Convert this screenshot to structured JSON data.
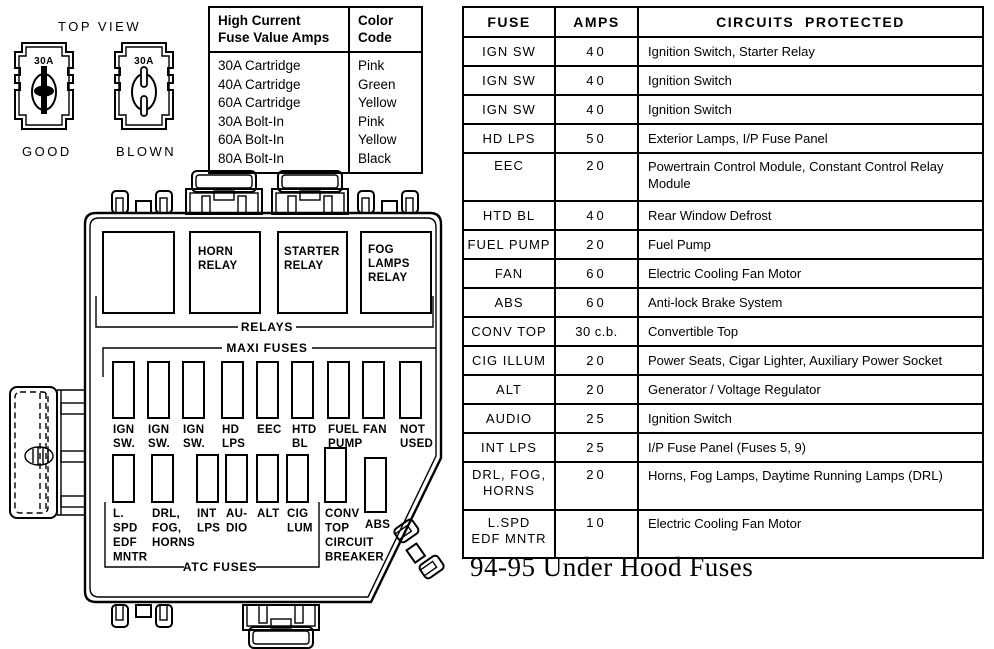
{
  "top_view": {
    "label": "TOP VIEW",
    "good": {
      "amps": "30A",
      "label": "GOOD"
    },
    "blown": {
      "amps": "30A",
      "label": "BLOWN"
    }
  },
  "legend": {
    "header_fuse": "High Current\nFuse Value Amps",
    "header_color": "Color\nCode",
    "rows": [
      {
        "value": "30A Cartridge",
        "color": "Pink"
      },
      {
        "value": "40A Cartridge",
        "color": "Green"
      },
      {
        "value": "60A Cartridge",
        "color": "Yellow"
      },
      {
        "value": "30A Bolt-In",
        "color": "Pink"
      },
      {
        "value": "60A Bolt-In",
        "color": "Yellow"
      },
      {
        "value": "80A Bolt-In",
        "color": "Black"
      }
    ]
  },
  "fuse_table": {
    "headers": {
      "fuse": "FUSE",
      "amps": "AMPS",
      "circuits": "CIRCUITS  PROTECTED"
    },
    "rows": [
      {
        "fuse": "IGN SW",
        "amps": "40",
        "circuits": "Ignition Switch, Starter Relay"
      },
      {
        "fuse": "IGN SW",
        "amps": "40",
        "circuits": "Ignition Switch"
      },
      {
        "fuse": "IGN SW",
        "amps": "40",
        "circuits": "Ignition Switch"
      },
      {
        "fuse": "HD LPS",
        "amps": "50",
        "circuits": "Exterior Lamps, I/P Fuse Panel"
      },
      {
        "fuse": "EEC",
        "amps": "20",
        "circuits": "Powertrain Control Module, Constant Control Relay\nModule"
      },
      {
        "fuse": "HTD BL",
        "amps": "40",
        "circuits": "Rear Window Defrost"
      },
      {
        "fuse": "FUEL PUMP",
        "amps": "20",
        "circuits": "Fuel Pump"
      },
      {
        "fuse": "FAN",
        "amps": "60",
        "circuits": "Electric Cooling Fan Motor"
      },
      {
        "fuse": "ABS",
        "amps": "60",
        "circuits": "Anti-lock Brake System"
      },
      {
        "fuse": "CONV TOP",
        "amps": "30 c.b.",
        "circuits": "Convertible Top"
      },
      {
        "fuse": "CIG ILLUM",
        "amps": "20",
        "circuits": "Power Seats, Cigar Lighter, Auxiliary Power Socket"
      },
      {
        "fuse": "ALT",
        "amps": "20",
        "circuits": "Generator / Voltage Regulator"
      },
      {
        "fuse": "AUDIO",
        "amps": "25",
        "circuits": "Ignition Switch"
      },
      {
        "fuse": "INT LPS",
        "amps": "25",
        "circuits": "I/P Fuse Panel (Fuses 5, 9)"
      },
      {
        "fuse": "DRL, FOG,\nHORNS",
        "amps": "20",
        "circuits": "Horns, Fog Lamps, Daytime Running Lamps (DRL)"
      },
      {
        "fuse": "L.SPD\nEDF MNTR",
        "amps": "10",
        "circuits": "Electric Cooling Fan Motor"
      }
    ]
  },
  "diagram": {
    "relays_label": "RELAYS",
    "maxi_label": "MAXI FUSES",
    "atc_label": "ATC FUSES",
    "relays": [
      [
        "HORN",
        "RELAY"
      ],
      [
        "STARTER",
        "RELAY"
      ],
      [
        "FOG",
        "LAMPS",
        "RELAY"
      ]
    ],
    "maxi": [
      [
        "IGN",
        "SW."
      ],
      [
        "IGN",
        "SW."
      ],
      [
        "IGN",
        "SW."
      ],
      [
        "HD",
        "LPS"
      ],
      [
        "EEC"
      ],
      [
        "HTD",
        "BL"
      ],
      [
        "FUEL",
        "PUMP"
      ],
      [
        "FAN"
      ],
      [
        "NOT",
        "USED"
      ]
    ],
    "atc": [
      [
        "L.",
        "SPD",
        "EDF",
        "MNTR"
      ],
      [
        "DRL,",
        "FOG,",
        "HORNS"
      ],
      [
        "INT",
        "LPS"
      ],
      [
        "AU-",
        "DIO"
      ],
      [
        "ALT"
      ],
      [
        "CIG",
        "LUM"
      ],
      [
        "CONV",
        "TOP",
        "CIRCUIT",
        "BREAKER"
      ],
      [
        "ABS"
      ]
    ]
  },
  "caption": "94-95 Under Hood Fuses"
}
